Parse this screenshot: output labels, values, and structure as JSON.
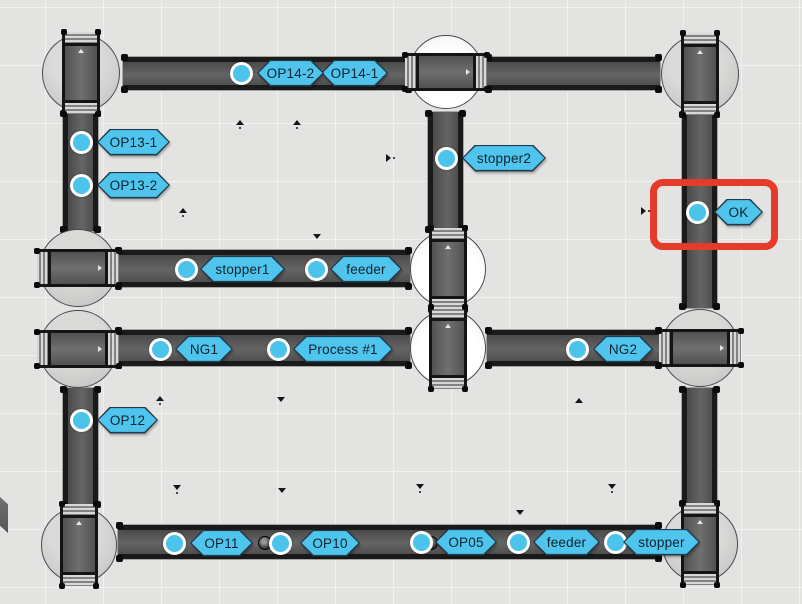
{
  "scene": {
    "width": 802,
    "height": 604,
    "background": "#e3e3e1",
    "grid": {
      "spacing": 58,
      "offset_x": 45,
      "offset_y": 7,
      "line_color": "#f1f1ef"
    }
  },
  "colors": {
    "tag_fill": "#4fc4ec",
    "tag_border": "#223a49",
    "tag_text": "#0d2430",
    "sensor_fill": "#4cc3ea",
    "sensor_ring": "#ffffff",
    "conveyor_frame": "#1a1a1a",
    "conveyor_surface": "#5a5a5a",
    "turntable_gray": "#cecece",
    "turntable_white": "#ffffff",
    "highlight_red": "#e63b28"
  },
  "conveyors": [
    {
      "id": "top-left-belt",
      "x": 123,
      "y": 57,
      "w": 287,
      "h": 33,
      "dir": "h"
    },
    {
      "id": "top-right-belt",
      "x": 487,
      "y": 57,
      "w": 173,
      "h": 33,
      "dir": "h"
    },
    {
      "id": "left-upper-belt",
      "x": 63,
      "y": 112,
      "w": 35,
      "h": 119,
      "dir": "v"
    },
    {
      "id": "mid-upper-belt",
      "x": 428,
      "y": 112,
      "w": 35,
      "h": 119,
      "dir": "v"
    },
    {
      "id": "right-upper-belt",
      "x": 682,
      "y": 113,
      "w": 35,
      "h": 195,
      "dir": "v"
    },
    {
      "id": "row2-belt",
      "x": 117,
      "y": 250,
      "w": 293,
      "h": 37,
      "dir": "h"
    },
    {
      "id": "row3-left-belt",
      "x": 117,
      "y": 330,
      "w": 293,
      "h": 36,
      "dir": "h"
    },
    {
      "id": "row3-right-belt",
      "x": 487,
      "y": 330,
      "w": 173,
      "h": 36,
      "dir": "h"
    },
    {
      "id": "left-lower-belt",
      "x": 63,
      "y": 388,
      "w": 35,
      "h": 118,
      "dir": "v"
    },
    {
      "id": "right-lower-belt",
      "x": 682,
      "y": 388,
      "w": 35,
      "h": 117,
      "dir": "v"
    },
    {
      "id": "bottom-belt",
      "x": 118,
      "y": 525,
      "w": 542,
      "h": 34,
      "dir": "h"
    }
  ],
  "turntables": [
    {
      "id": "top-left",
      "cx": 81,
      "cy": 73,
      "r": 39,
      "seg": "v",
      "tone": "gray"
    },
    {
      "id": "top-middle",
      "cx": 446,
      "cy": 72,
      "r": 37,
      "seg": "h",
      "tone": "white"
    },
    {
      "id": "top-right",
      "cx": 700,
      "cy": 74,
      "r": 39,
      "seg": "v",
      "tone": "gray"
    },
    {
      "id": "left-row2",
      "cx": 78,
      "cy": 268,
      "r": 39,
      "seg": "h",
      "tone": "gray"
    },
    {
      "id": "center-upper",
      "cx": 448,
      "cy": 269,
      "r": 38,
      "seg": "v",
      "tone": "white"
    },
    {
      "id": "center-lower",
      "cx": 448,
      "cy": 348,
      "r": 38,
      "seg": "v",
      "tone": "white"
    },
    {
      "id": "left-row3",
      "cx": 78,
      "cy": 349,
      "r": 39,
      "seg": "h",
      "tone": "gray"
    },
    {
      "id": "right-row3",
      "cx": 700,
      "cy": 348,
      "r": 39,
      "seg": "h",
      "tone": "gray"
    },
    {
      "id": "bottom-left",
      "cx": 79,
      "cy": 545,
      "r": 38,
      "seg": "v",
      "tone": "gray"
    },
    {
      "id": "bottom-right",
      "cx": 700,
      "cy": 544,
      "r": 38,
      "seg": "v",
      "tone": "gray"
    }
  ],
  "sensors": [
    {
      "name": "op14",
      "x": 241,
      "y": 73
    },
    {
      "name": "op13-1",
      "x": 81,
      "y": 142
    },
    {
      "name": "op13-2",
      "x": 81,
      "y": 185
    },
    {
      "name": "stopper2",
      "x": 446,
      "y": 158
    },
    {
      "name": "ok",
      "x": 697,
      "y": 212
    },
    {
      "name": "stopper1",
      "x": 186,
      "y": 269
    },
    {
      "name": "feeder-mid",
      "x": 316,
      "y": 269
    },
    {
      "name": "ng1",
      "x": 160,
      "y": 349
    },
    {
      "name": "process-1",
      "x": 278,
      "y": 349
    },
    {
      "name": "ng2",
      "x": 577,
      "y": 349
    },
    {
      "name": "op12",
      "x": 81,
      "y": 420
    },
    {
      "name": "op11",
      "x": 174,
      "y": 543
    },
    {
      "name": "op10",
      "x": 280,
      "y": 543
    },
    {
      "name": "op05",
      "x": 421,
      "y": 542
    },
    {
      "name": "feeder-bottom",
      "x": 518,
      "y": 542
    },
    {
      "name": "stopper-bottom",
      "x": 615,
      "y": 542
    }
  ],
  "tags": [
    {
      "name": "op14-1",
      "text": "OP14-1",
      "x": 321,
      "cy": 73,
      "w": 67
    },
    {
      "name": "op14-2",
      "text": "OP14-2",
      "x": 257,
      "cy": 73,
      "w": 67
    },
    {
      "name": "op13-1",
      "text": "OP13-1",
      "x": 97,
      "cy": 142,
      "w": 73
    },
    {
      "name": "op13-2",
      "text": "OP13-2",
      "x": 97,
      "cy": 185,
      "w": 73
    },
    {
      "name": "stopper2",
      "text": "stopper2",
      "x": 462,
      "cy": 158,
      "w": 84
    },
    {
      "name": "ok",
      "text": "OK",
      "x": 714,
      "cy": 212,
      "w": 49
    },
    {
      "name": "stopper1",
      "text": "stopper1",
      "x": 200,
      "cy": 269,
      "w": 85
    },
    {
      "name": "feeder-mid",
      "text": "feeder",
      "x": 330,
      "cy": 269,
      "w": 72
    },
    {
      "name": "ng1",
      "text": "NG1",
      "x": 175,
      "cy": 349,
      "w": 58
    },
    {
      "name": "process-1",
      "text": "Process #1",
      "x": 293,
      "cy": 349,
      "w": 100
    },
    {
      "name": "ng2",
      "text": "NG2",
      "x": 593,
      "cy": 349,
      "w": 60
    },
    {
      "name": "op12",
      "text": "OP12",
      "x": 97,
      "cy": 420,
      "w": 61
    },
    {
      "name": "op11",
      "text": "OP11",
      "x": 190,
      "cy": 543,
      "w": 63
    },
    {
      "name": "op10",
      "text": "OP10",
      "x": 300,
      "cy": 543,
      "w": 60
    },
    {
      "name": "op05",
      "text": "OP05",
      "x": 435,
      "cy": 542,
      "w": 62
    },
    {
      "name": "feeder-bottom",
      "text": "feeder",
      "x": 533,
      "cy": 542,
      "w": 67
    },
    {
      "name": "stopper-bottom",
      "text": "stopper",
      "x": 623,
      "cy": 542,
      "w": 77
    }
  ],
  "highlight": {
    "x": 650,
    "y": 179,
    "w": 128,
    "h": 71
  },
  "pucks": [
    {
      "x": 265,
      "y": 543
    },
    {
      "x": 431,
      "y": 543
    }
  ],
  "markers": [
    {
      "x": 240,
      "y": 124,
      "dir": "up",
      "dot": true
    },
    {
      "x": 297,
      "y": 124,
      "dir": "up",
      "dot": true
    },
    {
      "x": 390,
      "y": 158,
      "dir": "right",
      "dot": true
    },
    {
      "x": 183,
      "y": 212,
      "dir": "up",
      "dot": true
    },
    {
      "x": 317,
      "y": 238,
      "dir": "down",
      "dot": false
    },
    {
      "x": 645,
      "y": 211,
      "dir": "right",
      "dot": true
    },
    {
      "x": 160,
      "y": 400,
      "dir": "up",
      "dot": true
    },
    {
      "x": 281,
      "y": 401,
      "dir": "down",
      "dot": false
    },
    {
      "x": 579,
      "y": 402,
      "dir": "up",
      "dot": false
    },
    {
      "x": 420,
      "y": 488,
      "dir": "down",
      "dot": true
    },
    {
      "x": 177,
      "y": 489,
      "dir": "down",
      "dot": true
    },
    {
      "x": 282,
      "y": 492,
      "dir": "down",
      "dot": false
    },
    {
      "x": 612,
      "y": 488,
      "dir": "down",
      "dot": true
    },
    {
      "x": 520,
      "y": 514,
      "dir": "down",
      "dot": false
    }
  ],
  "wedge": {
    "x": 0,
    "y": 497,
    "w": 8,
    "h": 36
  }
}
